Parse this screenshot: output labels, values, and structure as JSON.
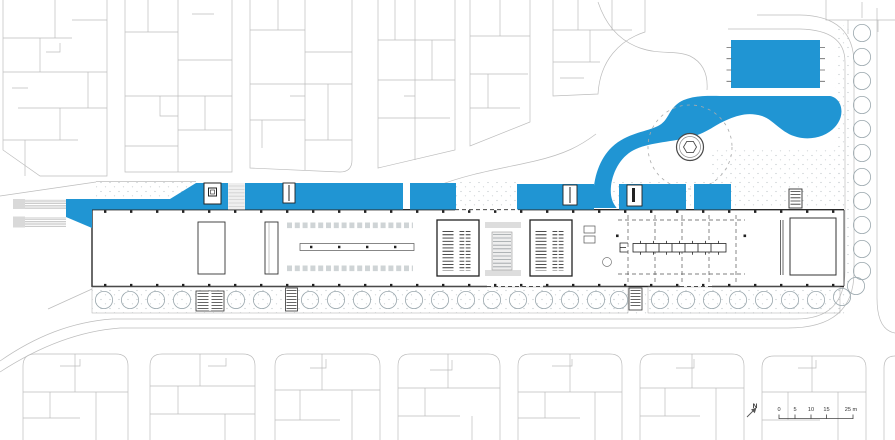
{
  "plan": {
    "kind": "architectural-site-plan",
    "compass": {
      "label": "N"
    },
    "scale_bar": {
      "tick_labels": [
        "0",
        "5",
        "10",
        "15"
      ],
      "end_label": "25 m"
    }
  },
  "colors": {
    "highlight_blue": "#2095d3",
    "context_line": "#bdbdbd",
    "building_line": "#2a2a2a",
    "tree_line": "#9aa7ad",
    "paving_gray": "#ececec",
    "stipple_gray": "#c4cacd"
  },
  "icons": {
    "north-arrow": "↗",
    "tree-icon": "○",
    "pavilion-icon": "◎",
    "pool-icon": "▭",
    "stair-icon": "☰"
  }
}
